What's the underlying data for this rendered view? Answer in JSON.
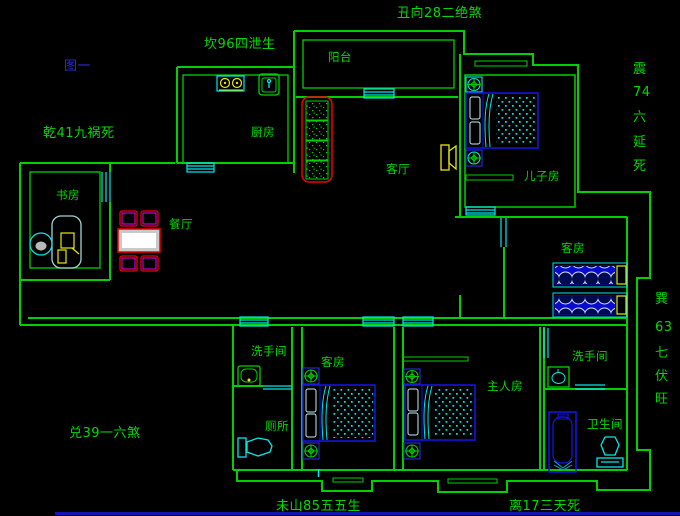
{
  "annotations": {
    "chou": "丑向28二绝煞",
    "kan": "坎96四泄生",
    "figure_label": "图一",
    "qian": "乾41九祸死",
    "zhen": [
      "震",
      "74",
      "六",
      "延",
      "死"
    ],
    "xun": [
      "巽",
      "63",
      "七",
      "伏",
      "旺"
    ],
    "dui": "兑39一六煞",
    "wei": "未山85五五生",
    "li": "离17三天死"
  },
  "rooms": {
    "balcony": "阳台",
    "kitchen": "厨房",
    "living_room": "客厅",
    "son_room": "儿子房",
    "study": "书房",
    "dining": "餐厅",
    "guest_room_upper": "客房",
    "guest_room_lower": "客房",
    "washroom_left": "洗手间",
    "washroom_right": "洗手间",
    "toilet": "厕所",
    "master_room": "主人房",
    "bathroom": "卫生间"
  },
  "colors": {
    "background": "#000000",
    "wall_green": "#00cf00",
    "text_green": "#00d900",
    "figure_blue": "#2a2ae0",
    "window_cyan": "#00e8e8",
    "furniture_blue": "#1515e8",
    "accent_yellow": "#e8e800",
    "accent_red": "#ee0000",
    "accent_magenta": "#ee00ee",
    "statusbar_blue": "#1414b4"
  }
}
